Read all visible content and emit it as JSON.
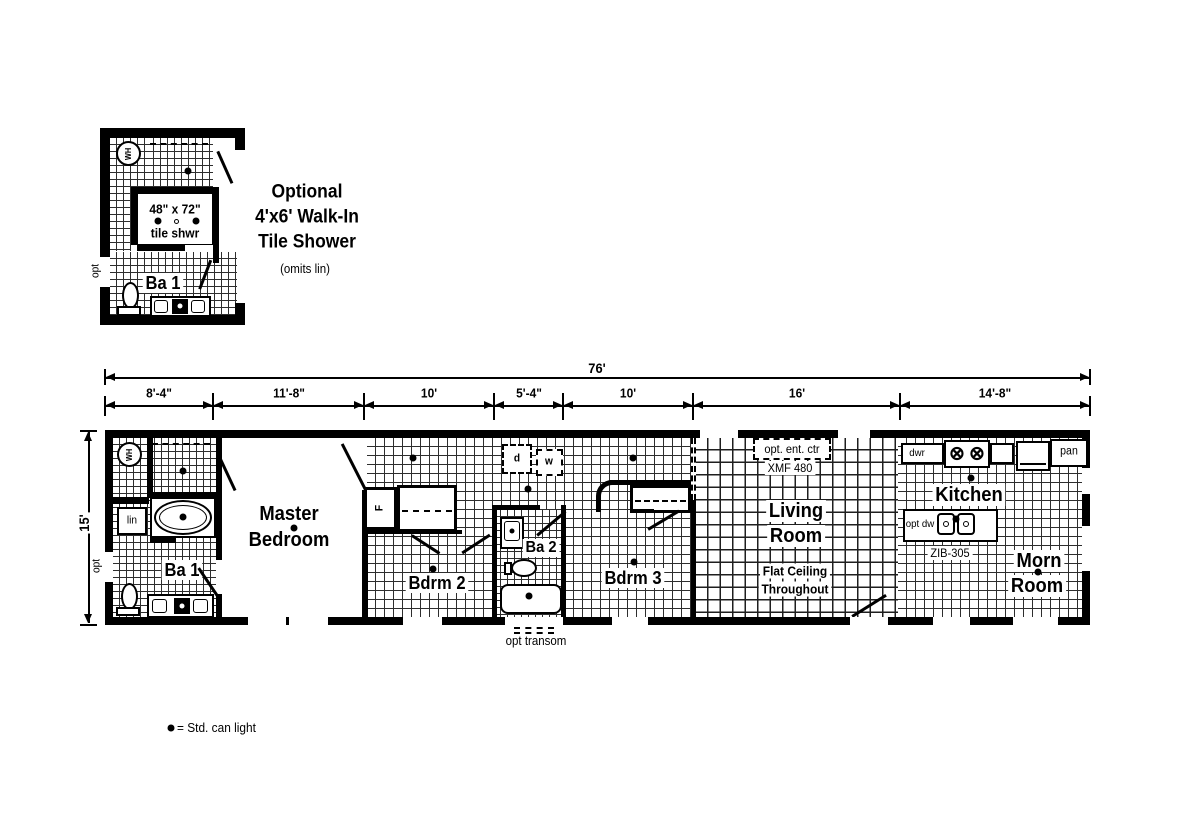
{
  "inset": {
    "title_lines": [
      "Optional",
      "4'x6' Walk-In",
      "Tile Shower"
    ],
    "subtitle": "(omits lin)",
    "shower_size": "48\" x 72\"",
    "shower_label": "tile shwr",
    "room_label": "Ba 1",
    "opt_label": "opt",
    "wh_label": "WH"
  },
  "dimensions": {
    "overall": "76'",
    "height": "15'",
    "segments": [
      "8'-4\"",
      "11'-8\"",
      "10'",
      "5'-4\"",
      "10'",
      "16'",
      "14'-8\""
    ]
  },
  "plan": {
    "wh_label": "WH",
    "opt_label": "opt",
    "lin_label": "lin",
    "ba1_label": "Ba 1",
    "master_lines": [
      "Master",
      "Bedroom"
    ],
    "furnace_label": "F",
    "dryer_label": "d",
    "washer_label": "w",
    "bdrm2_label": "Bdrm 2",
    "ba2_label": "Ba 2",
    "bdrm3_label": "Bdrm 3",
    "living_lines": [
      "Living",
      "Room"
    ],
    "living_note_lines": [
      "Flat Ceiling",
      "Throughout"
    ],
    "ent_ctr_label": "opt. ent. ctr",
    "ent_ctr_model": "XMF 480",
    "kitchen_label": "Kitchen",
    "island_model": "ZIB-305",
    "opt_dw_label": "opt dw",
    "dwr_label": "dwr",
    "pan_label": "pan",
    "morn_lines": [
      "Morn",
      "Room"
    ],
    "transom_label": "opt transom",
    "burner_glyph": "⊗"
  },
  "legend": {
    "can_light": "= Std. can light"
  }
}
